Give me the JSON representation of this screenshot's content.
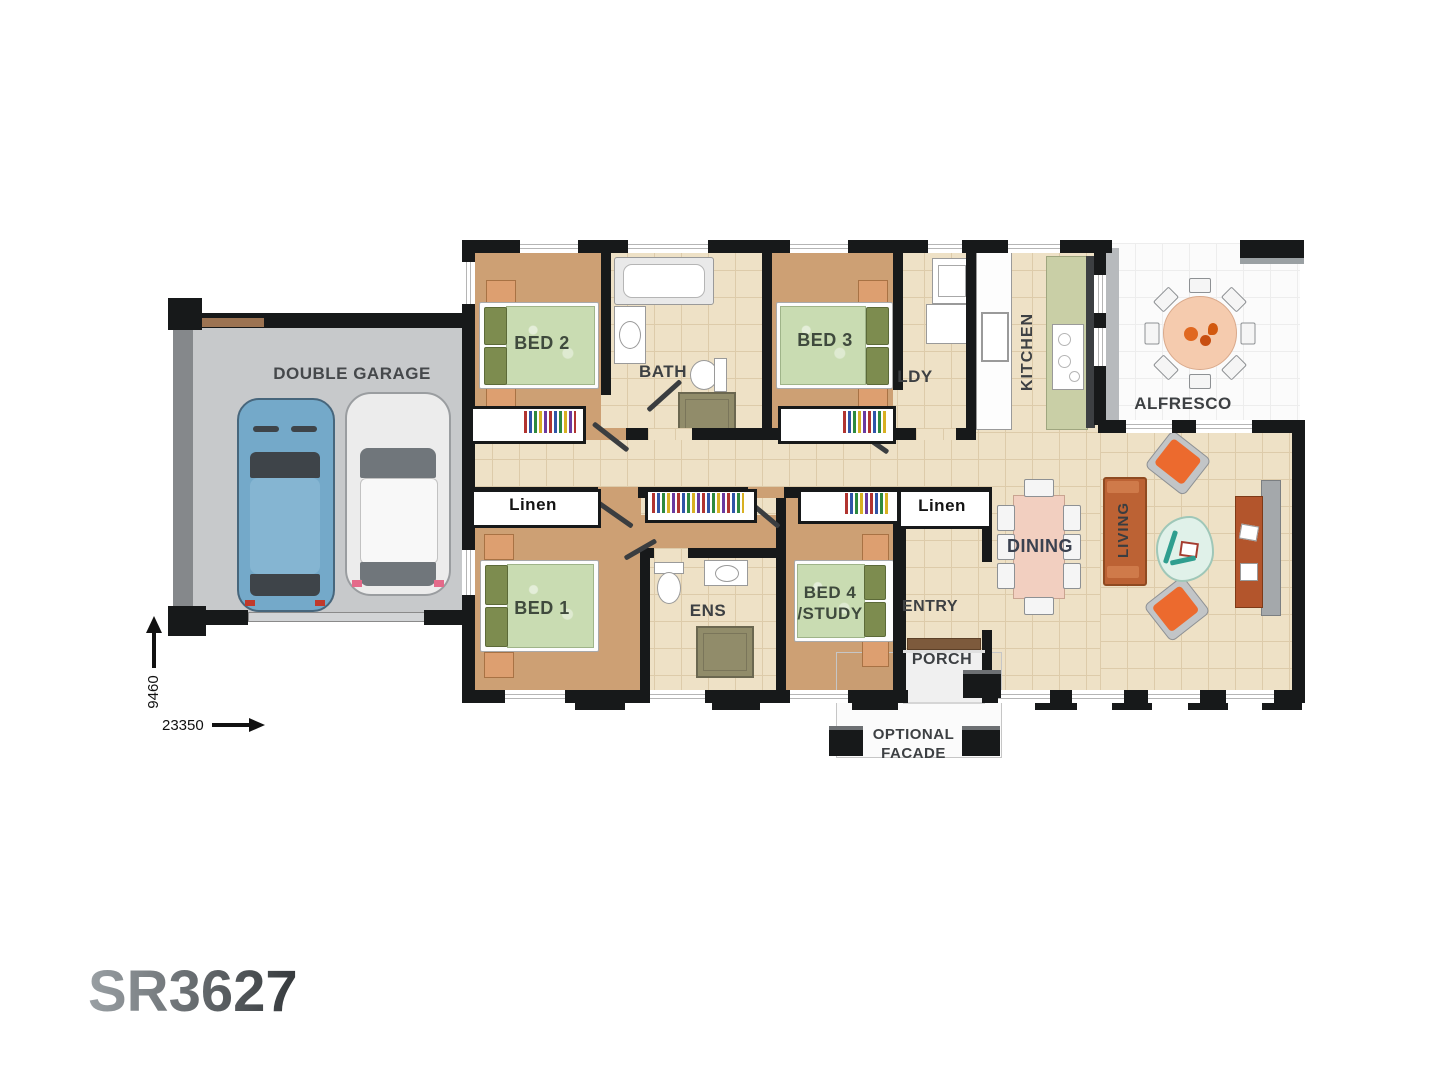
{
  "title": "SR3627",
  "plan": {
    "rooms": [
      {
        "id": "garage",
        "label": "DOUBLE GARAGE"
      },
      {
        "id": "bed2",
        "label": "BED 2"
      },
      {
        "id": "bath",
        "label": "BATH"
      },
      {
        "id": "bed3",
        "label": "BED 3"
      },
      {
        "id": "ldy",
        "label": "LDY"
      },
      {
        "id": "kitchen",
        "label": "KITCHEN"
      },
      {
        "id": "alfresco",
        "label": "ALFRESCO"
      },
      {
        "id": "linen-left",
        "label": "Linen"
      },
      {
        "id": "bed1",
        "label": "BED 1"
      },
      {
        "id": "ens",
        "label": "ENS"
      },
      {
        "id": "bed4-study",
        "label": "BED 4",
        "label2": "/STUDY"
      },
      {
        "id": "entry",
        "label": "ENTRY"
      },
      {
        "id": "linen-right",
        "label": "Linen"
      },
      {
        "id": "dining",
        "label": "DINING"
      },
      {
        "id": "living",
        "label": "LIVING"
      },
      {
        "id": "porch",
        "label": "PORCH"
      },
      {
        "id": "optional-facade",
        "label": "OPTIONAL",
        "label2": "FACADE"
      }
    ],
    "dimensions": {
      "depth": "9460",
      "width": "23350"
    }
  },
  "colors": {
    "wall": "#17191a",
    "carpet": "#cda074",
    "tile": "#eee1c6",
    "grout": "#ddcbaa",
    "garage_floor": "#c7c9cb",
    "garage_wall": "#85888b",
    "alfresco_floor": "#fbfbfb",
    "bed_green": "#c9dcb2",
    "pillow_green": "#7d8c4f",
    "nightstand": "#dd9f70",
    "sofa": "#bc6234",
    "sofa_dark": "#8f4a21",
    "armchair": "#ec6a2e",
    "chair_gray": "#c2c5c7",
    "coffee_table": "#e0f1e9",
    "tv_cabinet": "#b3552c",
    "tv_panel": "#a4a8ab",
    "dining_table": "#f2cfc0",
    "alfresco_table": "#f5cbae",
    "counter_green": "#c9cfa6",
    "car_blue": "#74a9c9",
    "car_white": "#ececec",
    "shower": "#918c6a",
    "label": "#3d4043",
    "label_green": "#3f4a3d",
    "dining_label": "#3a4150",
    "door": "#3a3d40",
    "window_line": "#b5b5b5",
    "title_from": "#9aa0a4",
    "title_to": "#35393c"
  }
}
